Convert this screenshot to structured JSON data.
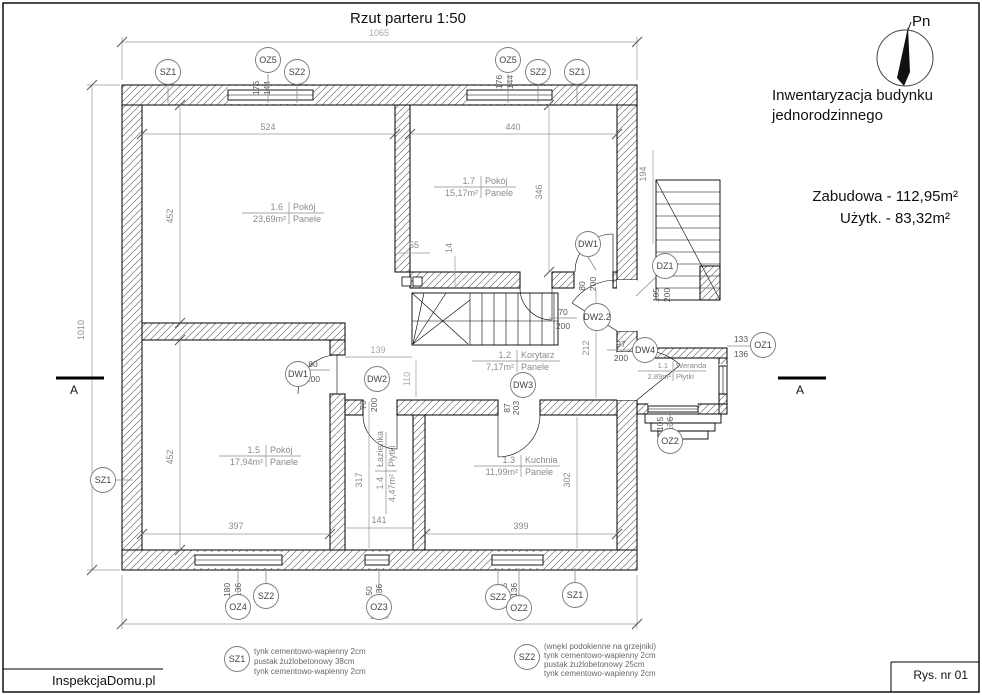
{
  "title": "Rzut parteru 1:50",
  "compass": {
    "label": "Pn"
  },
  "info": {
    "line1": "Inwentaryzacja budynku",
    "line2": "jednorodzinnego",
    "built_area": "Zabudowa - 112,95m²",
    "usable_area": "Użytk. - 83,32m²"
  },
  "rooms": {
    "r16": {
      "no": "1.6",
      "name": "Pokój",
      "area": "23,69m²",
      "floor": "Panele"
    },
    "r17": {
      "no": "1.7",
      "name": "Pokój",
      "area": "15,17m²",
      "floor": "Panele"
    },
    "r15": {
      "no": "1.5",
      "name": "Pokój",
      "area": "17,94m²",
      "floor": "Panele"
    },
    "r13": {
      "no": "1.3",
      "name": "Kuchnia",
      "area": "11,99m²",
      "floor": "Panele"
    },
    "r12": {
      "no": "1.2",
      "name": "Korytarz",
      "area": "7,17m²",
      "floor": "Panele"
    },
    "r14": {
      "no": "1.4",
      "name": "Łazienka",
      "area": "4,47m²",
      "floor": "Płytki"
    },
    "r11": {
      "no": "1.1",
      "name": "Weranda",
      "area": "2,89m²",
      "floor": "Płytki"
    }
  },
  "dims": {
    "overall_w_top": "1065",
    "overall_w_bottom": "1065",
    "overall_h_left": "1010",
    "r16_w": "524",
    "r17_w": "440",
    "r16_h": "452",
    "r17_h": "346",
    "r15_h": "452",
    "r15_w": "397",
    "r13_w": "399",
    "r14_h": "317",
    "r14_w": "141",
    "r13_h": "302",
    "hall_h": "212",
    "ext_stairs_h": "194",
    "stair_w": "55",
    "stair_o": "14",
    "corr_w": "139",
    "corr_h": "110"
  },
  "tags": {
    "sz1": "SZ1",
    "sz2": "SZ2",
    "oz1": "OZ1",
    "oz2": "OZ2",
    "oz3": "OZ3",
    "oz4": "OZ4",
    "oz5": "OZ5",
    "dw1": "DW1",
    "dw2": "DW2",
    "dw22": "DW2.2",
    "dw3": "DW3",
    "dw4": "DW4",
    "dz1": "DZ1"
  },
  "sizes": {
    "oz5_w": "176",
    "oz5_h": "144",
    "oz4_w": "180",
    "oz4_h": "136",
    "oz3_w": "50",
    "oz3_h": "136",
    "oz2_w": "105",
    "oz2_h": "136",
    "oz1_w": "133",
    "oz1_h": "136",
    "dz1_w": "105",
    "dz1_h": "200",
    "dw1_w": "80",
    "dw1_h": "200",
    "dw2_w": "70",
    "dw2_h": "200",
    "dw22_w": "70",
    "dw22_h": "200",
    "dw3_w": "87",
    "dw3_h": "203",
    "dw4_w": "97",
    "dw4_h": "200"
  },
  "section": {
    "mark": "A"
  },
  "legend": {
    "sz1_tag": "SZ1",
    "sz1_l1": "tynk cementowo-wapienny 2cm",
    "sz1_l2": "pustak żużlobetonowy 38cm",
    "sz1_l3": "tynk cementowo-wapienny 2cm",
    "sz2_tag": "SZ2",
    "sz2_l0": "(wnęki podokienne na grzejniki)",
    "sz2_l1": "tynk cementowo-wapienny 2cm",
    "sz2_l2": "pustak żużlobetonowy 25cm",
    "sz2_l3": "tynk cementowo-wapienny 2cm"
  },
  "footer": {
    "brand": "InspekcjaDomu.pl",
    "drawing_no": "Rys. nr 01"
  }
}
